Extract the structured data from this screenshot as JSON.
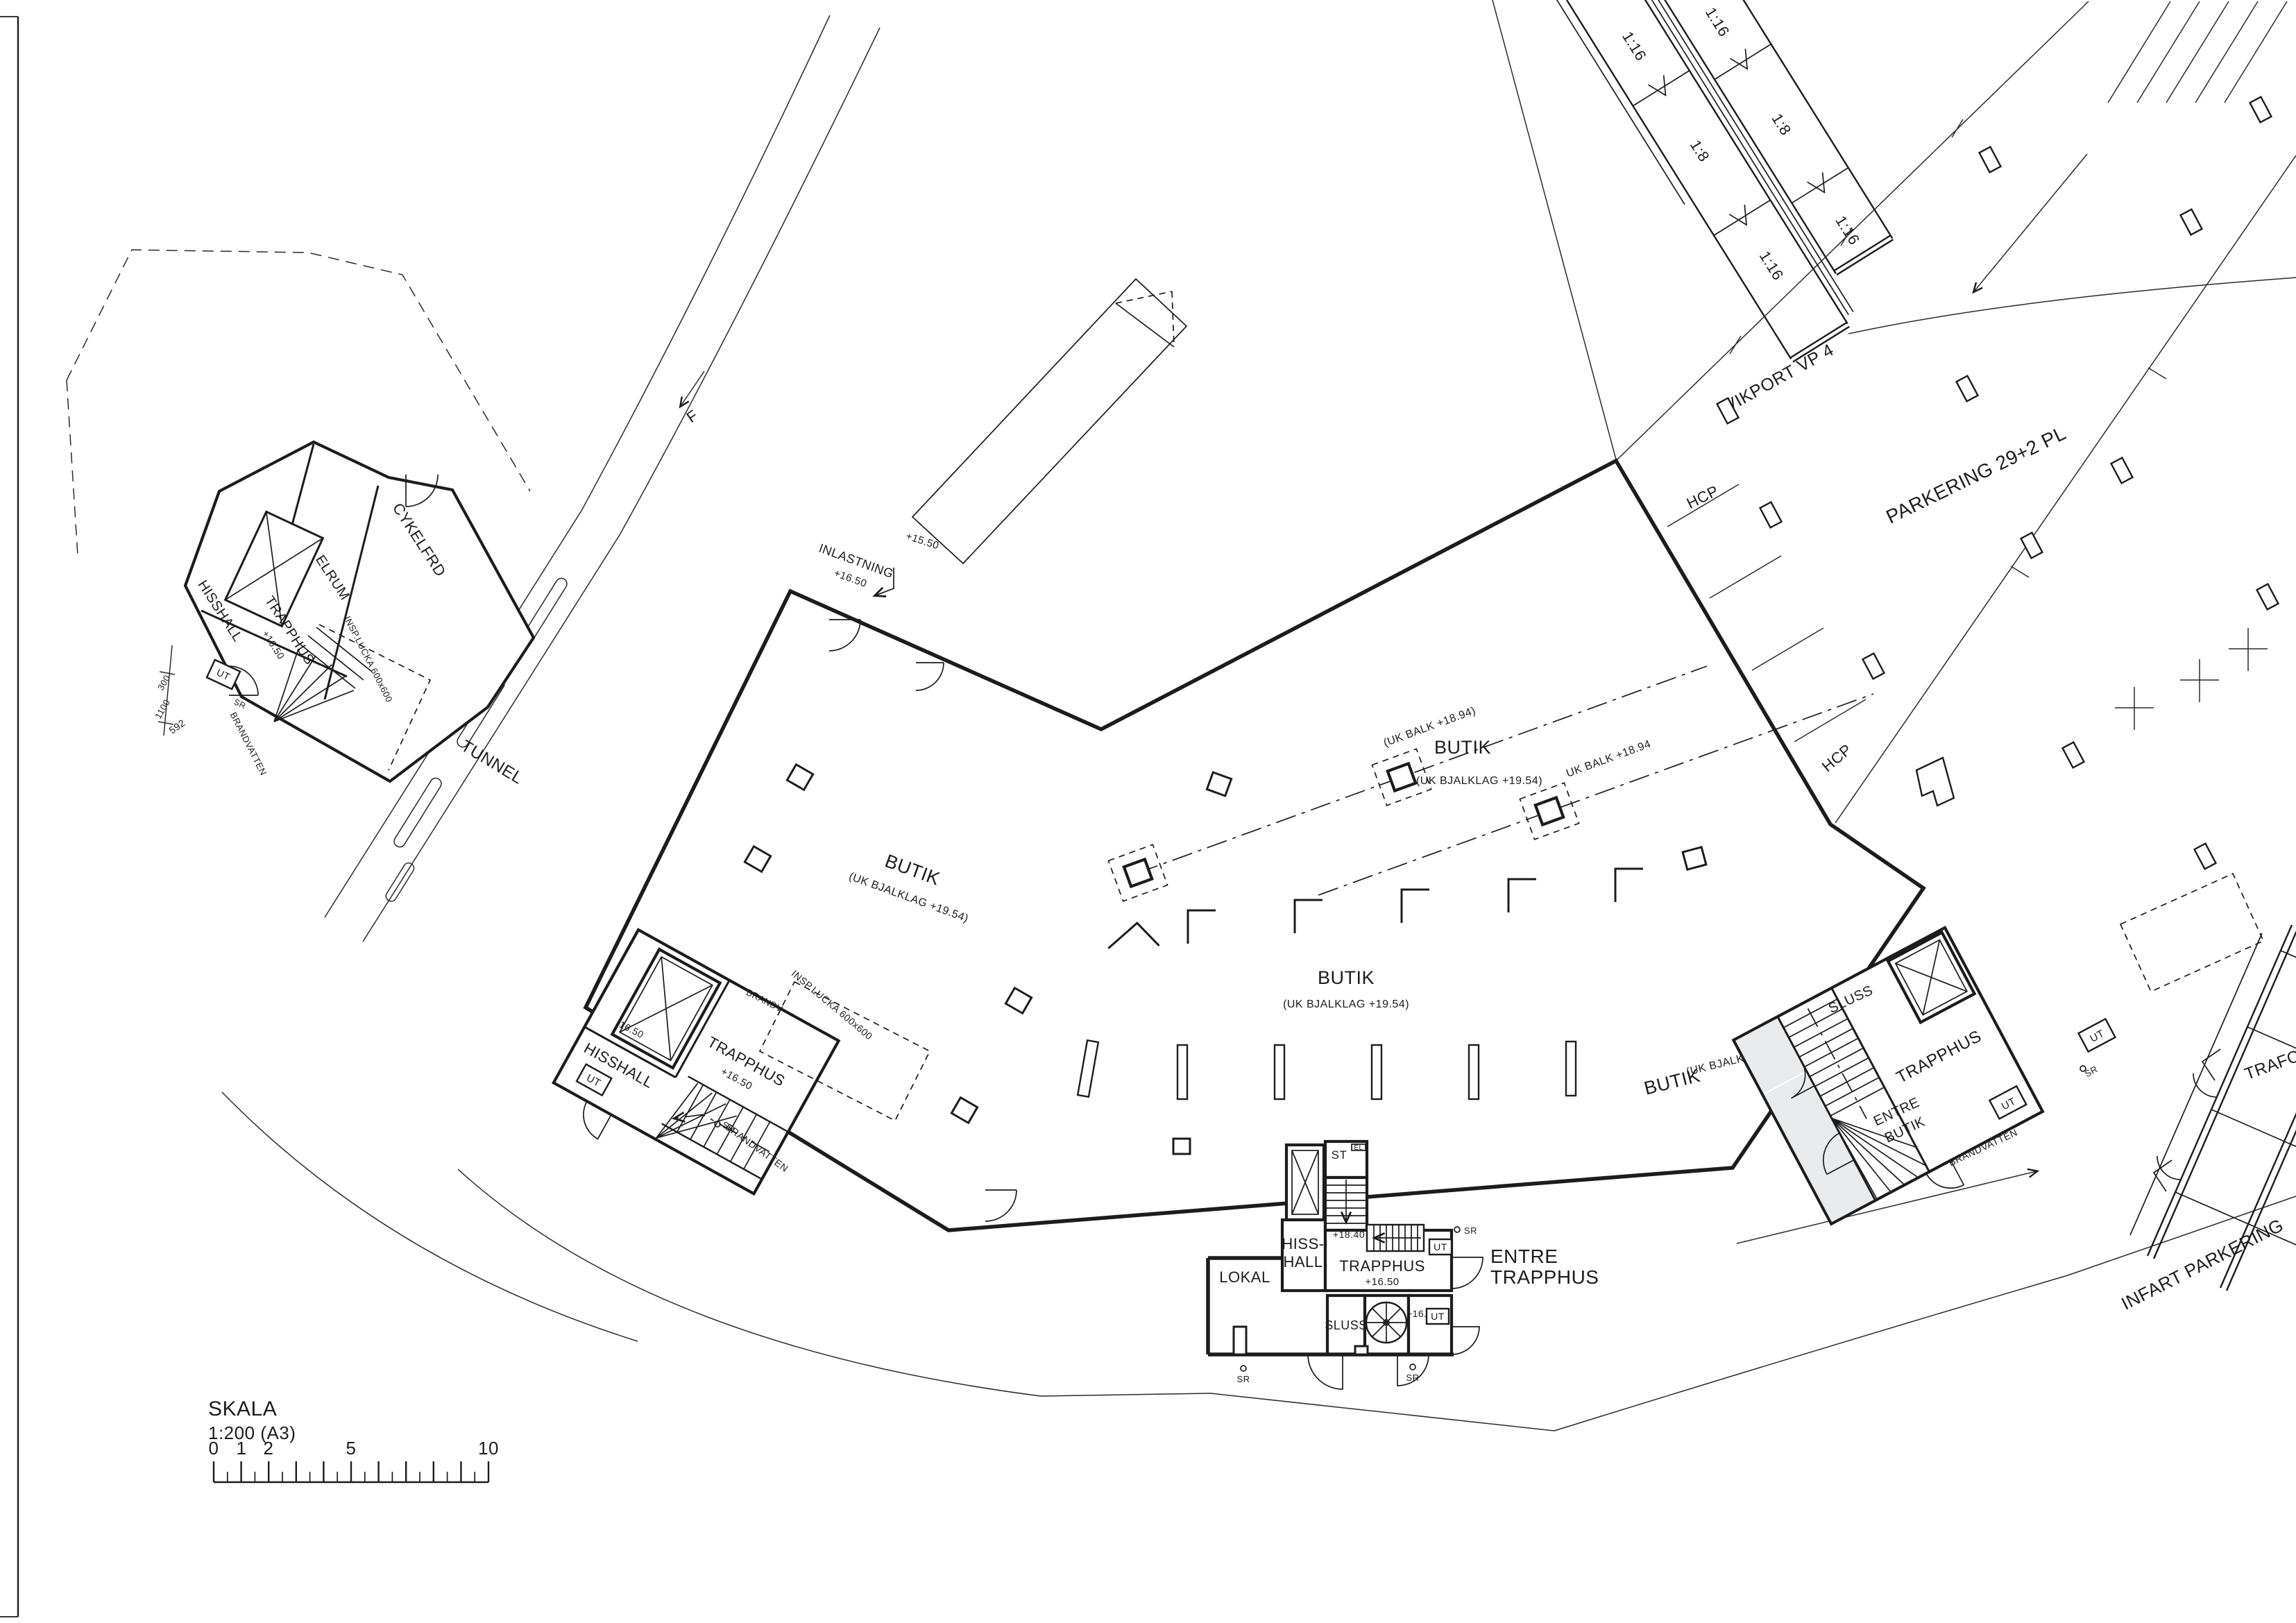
{
  "colors": {
    "ink": "#1c1c1c",
    "hall_fill": "#e9eaeb",
    "paper": "#ffffff"
  },
  "scalebar": {
    "title": "SKALA",
    "ratio": "1:200 (A3)",
    "t0": "0",
    "t1": "1",
    "t2": "2",
    "t5": "5",
    "t10": "10"
  },
  "site": {
    "tunnel": "TUNNEL",
    "vikport": "VIKPORT VP 4",
    "parkering": "PARKERING 29+2 PL",
    "hcp": "HCP",
    "infart": "INFART PARKERING",
    "trafo": "TRAFO",
    "marker_f": "F",
    "grade_116": "1:16",
    "grade_18": "1:8"
  },
  "hall": {
    "butik": "BUTIK",
    "bjalklag": "(UK BJALKLAG +19.54)",
    "balk_paren": "(UK BALK +18.94)",
    "balk": "UK BALK +18.94",
    "inlastning": "INLASTNING",
    "lvl_1650": "+16.50",
    "lvl_1550": "+15.50"
  },
  "left_core": {
    "hisshall": "HISSHALL",
    "trapphus": "TRAPPHUS",
    "lvl": "+16.50",
    "ut": "UT",
    "sr": "SR",
    "brandv": "BRANDV",
    "brandvatten": "BRANDVATTEN",
    "insp": "INSP.LUCKA 600x600",
    "dim": "16.50"
  },
  "annex": {
    "st": "ST",
    "el": "EL",
    "hiss1": "HISS-",
    "hiss2": "HALL",
    "lvl_1840": "+18.40",
    "trapphus": "TRAPPHUS",
    "lvl_1650": "+16.50",
    "ut": "UT",
    "entre1": "ENTRE",
    "entre2": "TRAPPHUS",
    "lokal": "LOKAL",
    "sluss": "SLUSS",
    "sr": "SR"
  },
  "right_core": {
    "sluss": "SLUSS",
    "trapphus": "TRAPPHUS",
    "entre1": "ENTRE",
    "entre2": "BUTIK",
    "ut": "UT",
    "sr": "SR",
    "brandvatten": "BRANDVATTEN"
  },
  "outbuilding": {
    "cykelfrd": "CYKELFRD",
    "elrum": "ELRUM",
    "hisshall": "HISSHALL",
    "trapphus": "TRAPPHUS",
    "lvl": "+16.50",
    "ut": "UT",
    "sr": "SR",
    "brandvatten": "BRANDVATTEN",
    "insp": "INSP.LUCKA 600x600",
    "dim_592": "592",
    "dim_300": "300",
    "dim_1100": "1100"
  }
}
